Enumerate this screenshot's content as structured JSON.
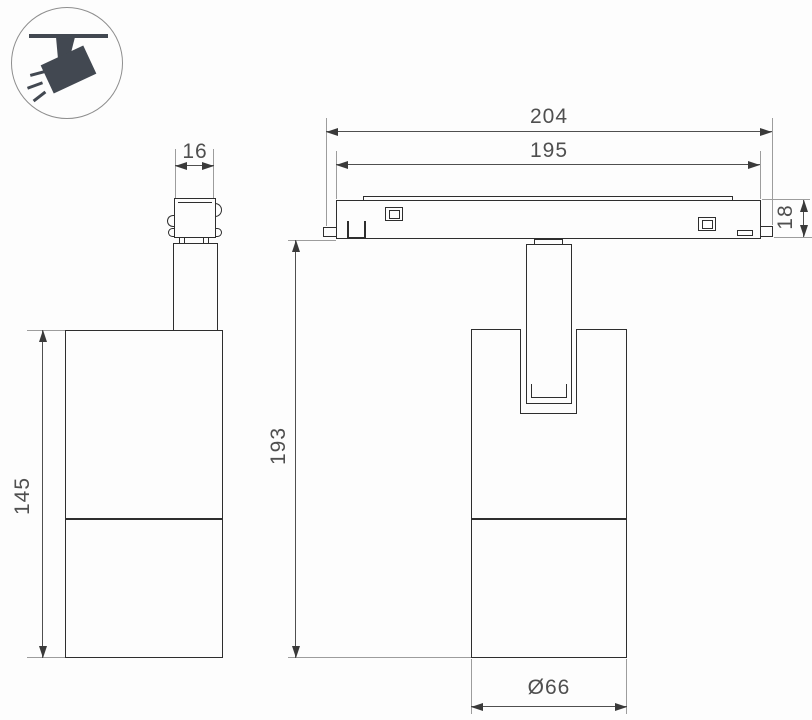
{
  "colors": {
    "background": "#fdfdfd",
    "object_line": "#2e2e2e",
    "dimension_line": "#4f4f4f",
    "extension_line": "#9d9d9d",
    "label_text": "#4f4f4f",
    "icon_fill": "#424851",
    "icon_circle_border": "#8e8e8e"
  },
  "icon": {
    "name": "ceiling-track-spotlight-icon"
  },
  "side_view": {
    "adapter_width_label": "16",
    "body_height_label": "145"
  },
  "front_view": {
    "track_outer_width_label": "204",
    "track_inner_width_label": "195",
    "track_height_label": "18",
    "overall_height_label": "193",
    "diameter_label": "Ø66"
  }
}
